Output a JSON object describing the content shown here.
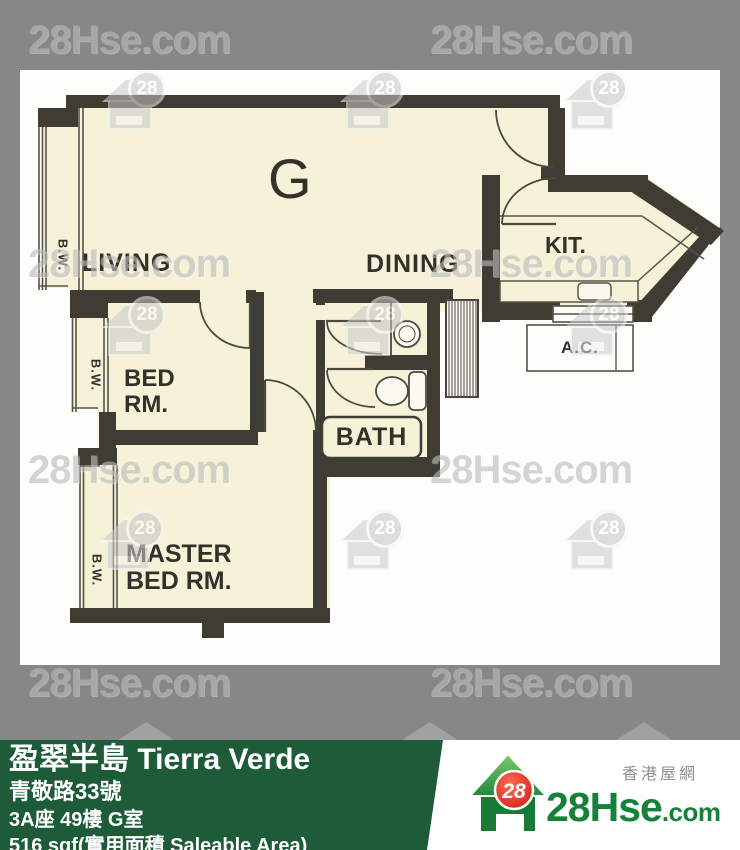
{
  "plan": {
    "unit_letter": "G",
    "labels": {
      "living": "LIVING",
      "dining": "DINING",
      "kitchen": "KIT.",
      "bath": "BATH",
      "ac": "A.C.",
      "bay_window": "B.W.",
      "bedroom": [
        "BED",
        "RM."
      ],
      "master_bedroom": [
        "MASTER",
        "BED RM."
      ]
    }
  },
  "watermark": {
    "text": "28Hse.com",
    "badge": "28"
  },
  "footer": {
    "estate_name": "盈翠半島 Tierra Verde",
    "address": "青敬路33號",
    "unit": "3A座 49樓 G室",
    "area": "516 sqf(實用面積 Saleable Area)",
    "brand": {
      "badge": "28",
      "name_main": "28Hse",
      "name_suffix": ".com",
      "tagline": "香港屋網"
    }
  },
  "colors": {
    "footer_green": "#1e5b38",
    "brand_green": "#15813a",
    "brand_red": "#e02418",
    "wall": "#3f3d33",
    "floor_cream": "#f5f2d8"
  }
}
